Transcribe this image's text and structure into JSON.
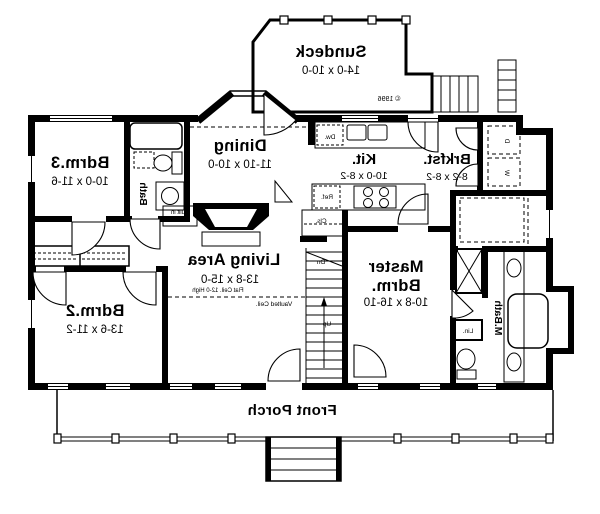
{
  "floorplan": {
    "copyright": "© 1996",
    "sundeck": {
      "name": "Sundeck",
      "dims": "14-0 x 10-0"
    },
    "bdrm3": {
      "name": "Bdrm.3",
      "dims": "10-0 x 11-6"
    },
    "bath": {
      "name": "Bath"
    },
    "dining": {
      "name": "Dining",
      "dims": "11-10 x 10-0"
    },
    "kitchen": {
      "name": "Kit.",
      "dims": "10-0 x 8-2"
    },
    "brkfst": {
      "name": "Brkfst.",
      "dims": "8-2 x 8-2"
    },
    "living": {
      "name": "Living Area",
      "dims": "13-8 x 15-0",
      "flat_ceil": "Flat Ceil. 12-0 High",
      "vaulted_ceil": "Vaulted Ceil."
    },
    "master": {
      "name_line1": "Master",
      "name_line2": "Bdrm.",
      "dims": "10-8 x 16-10"
    },
    "mbath": {
      "name": "M.Bath"
    },
    "bdrm2": {
      "name": "Bdrm.2",
      "dims": "13-6 x 11-2"
    },
    "porch": {
      "name": "Front Porch"
    },
    "labels": {
      "built_in_cab_1": "Built in",
      "built_in_cab_2": "Cab.",
      "dw": "Dw.",
      "ref": "Ref.",
      "cls": "Cls.",
      "lin": "Lin.",
      "washer": "W",
      "dryer": "D",
      "up": "Up",
      "dn": "Dn"
    }
  }
}
